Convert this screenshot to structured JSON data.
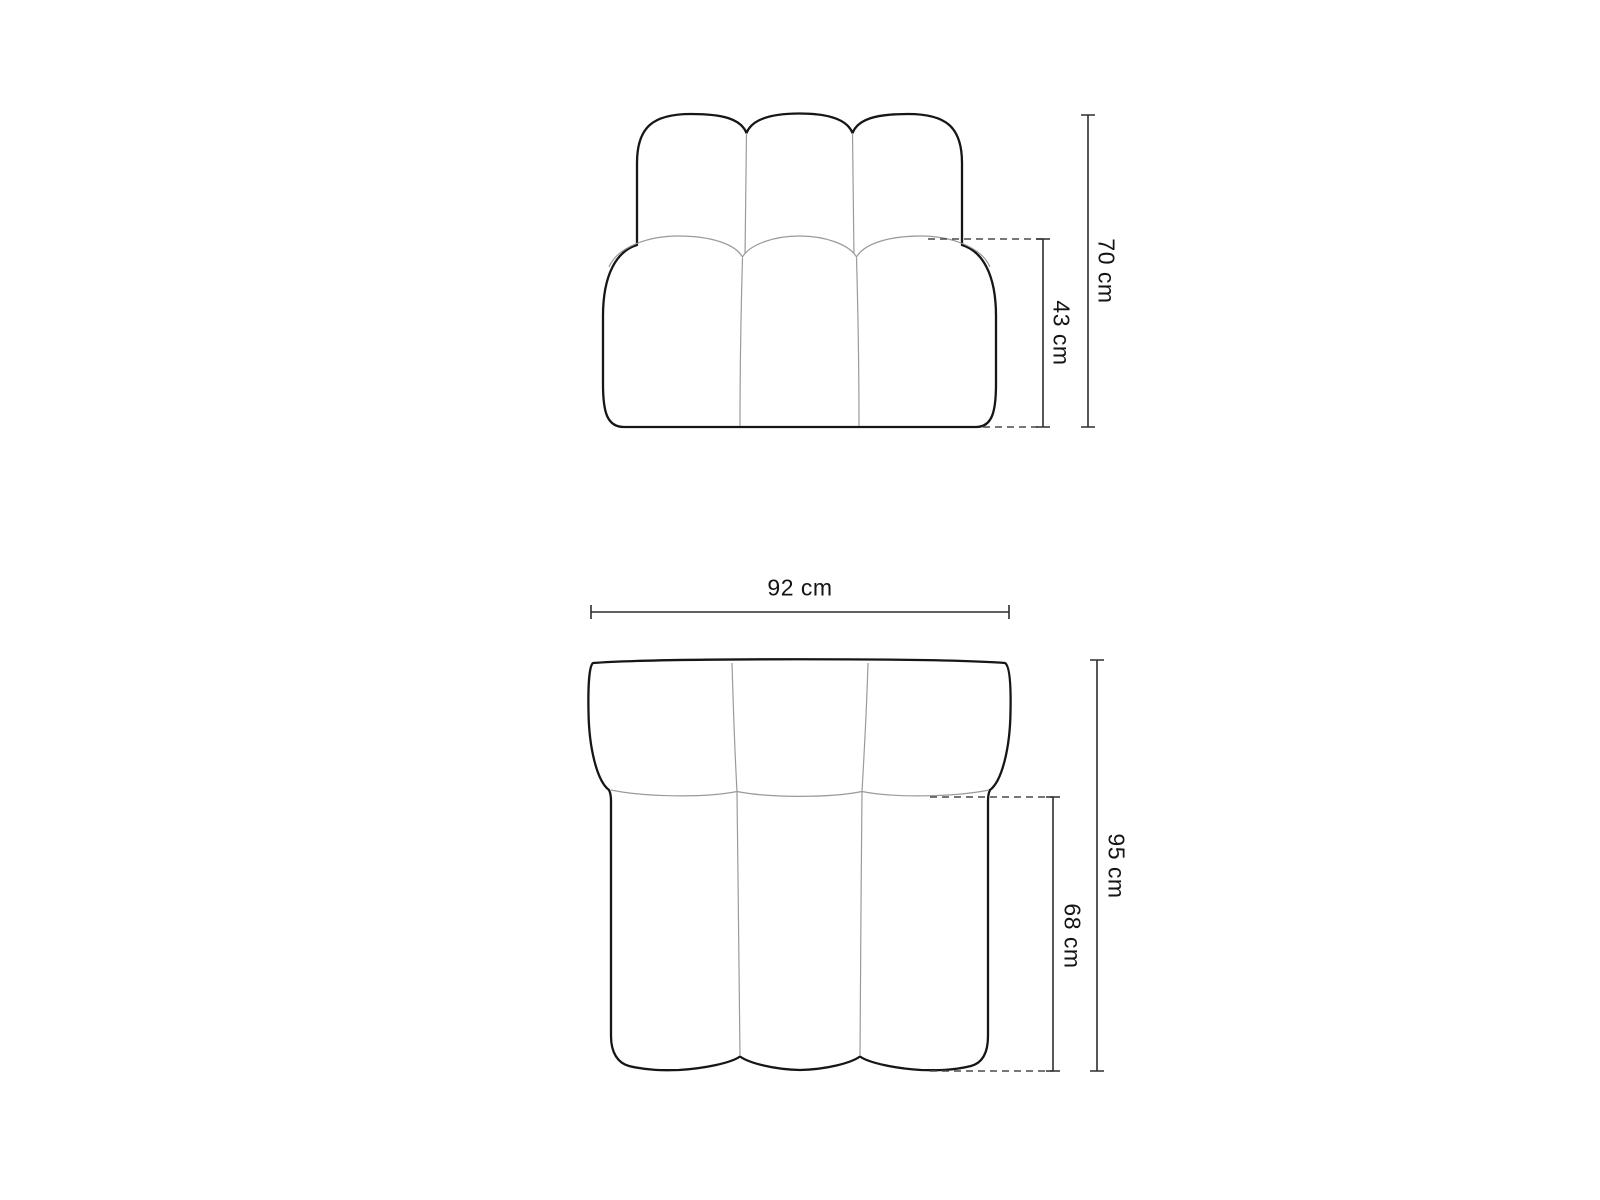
{
  "diagram": {
    "type": "furniture-dimension-diagram",
    "subject": "channel-tufted modular sofa seat module, front elevation and top plan views",
    "views": [
      {
        "id": "front",
        "name": "front-view",
        "dimensions": [
          {
            "id": "total-height",
            "label": "70 cm",
            "value": 70,
            "unit": "cm",
            "axis": "vertical"
          },
          {
            "id": "seat-height",
            "label": "43 cm",
            "value": 43,
            "unit": "cm",
            "axis": "vertical"
          }
        ]
      },
      {
        "id": "top",
        "name": "top-view",
        "dimensions": [
          {
            "id": "width",
            "label": "92 cm",
            "value": 92,
            "unit": "cm",
            "axis": "horizontal"
          },
          {
            "id": "total-depth",
            "label": "95 cm",
            "value": 95,
            "unit": "cm",
            "axis": "vertical"
          },
          {
            "id": "seat-depth",
            "label": "68 cm",
            "value": 68,
            "unit": "cm",
            "axis": "vertical"
          }
        ]
      }
    ],
    "colors": {
      "outline": "#161616",
      "seam": "#9a9a9a",
      "dimension_line": "#2e2e2e",
      "extension_line": "#4a4a4a",
      "text": "#141414",
      "background": "#ffffff"
    }
  },
  "labels": {
    "front_total_height": "70 cm",
    "front_seat_height": "43 cm",
    "top_width": "92 cm",
    "top_total_depth": "95 cm",
    "top_seat_depth": "68 cm"
  }
}
